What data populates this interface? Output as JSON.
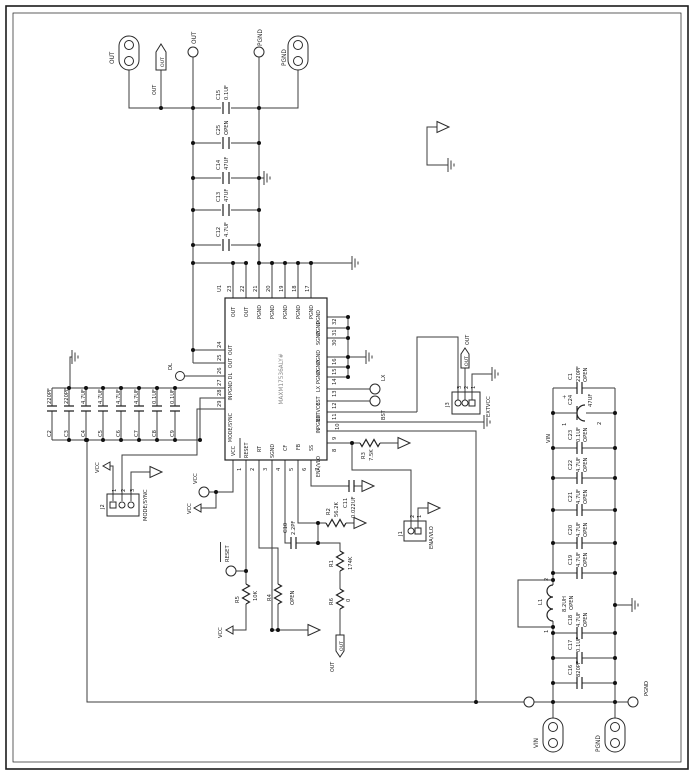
{
  "ic": {
    "ref": "U1",
    "part": "MAXM17536ALY#",
    "top_pins": [
      {
        "num": "23",
        "name": "OUT"
      },
      {
        "num": "22",
        "name": "OUT"
      },
      {
        "num": "21",
        "name": "PGND"
      },
      {
        "num": "20",
        "name": "PGND"
      },
      {
        "num": "19",
        "name": "PGND"
      },
      {
        "num": "18",
        "name": "PGND"
      },
      {
        "num": "17",
        "name": "PGND"
      }
    ],
    "left_pins": [
      {
        "num": "24",
        "name": "OUT"
      },
      {
        "num": "25",
        "name": "OUT"
      },
      {
        "num": "26",
        "name": "DL"
      },
      {
        "num": "27",
        "name": "PGND"
      },
      {
        "num": "28",
        "name": "IN"
      },
      {
        "num": "29",
        "name": "MODE/SYNC"
      }
    ],
    "right_pins": [
      {
        "num": "32",
        "name": "PGND"
      },
      {
        "num": "31",
        "name": "PGND"
      },
      {
        "num": "30",
        "name": "SGND"
      },
      {
        "num": "16",
        "name": "PGND"
      },
      {
        "num": "15",
        "name": "PGND"
      },
      {
        "num": "14",
        "name": "PGND"
      },
      {
        "num": "13",
        "name": "LX"
      },
      {
        "num": "12",
        "name": "BST"
      },
      {
        "num": "11",
        "name": "EXTVCC"
      },
      {
        "num": "10",
        "name": "PGND"
      },
      {
        "num": "9",
        "name": "IN"
      },
      {
        "num": "8",
        "name": "ENA/VLO"
      }
    ],
    "bottom_pins": [
      {
        "num": "1",
        "name": "VCC"
      },
      {
        "num": "2",
        "name": "RESET"
      },
      {
        "num": "3",
        "name": "RT"
      },
      {
        "num": "4",
        "name": "SGND"
      },
      {
        "num": "5",
        "name": "CF"
      },
      {
        "num": "6",
        "name": "FB"
      },
      {
        "num": "7",
        "name": "SS"
      }
    ]
  },
  "capacitors": {
    "C1": {
      "ref": "C1",
      "val": "220PF",
      "val2": "OPEN"
    },
    "C2": {
      "ref": "C2",
      "val": "220PF"
    },
    "C3": {
      "ref": "C3",
      "val": "220PF"
    },
    "C4": {
      "ref": "C4",
      "val": "4.7UF"
    },
    "C5": {
      "ref": "C5",
      "val": "4.7UF"
    },
    "C6": {
      "ref": "C6",
      "val": "4.7UF"
    },
    "C7": {
      "ref": "C7",
      "val": "4.7UF"
    },
    "C8": {
      "ref": "C8",
      "val": "0.1UF"
    },
    "C9": {
      "ref": "C9",
      "val": "0.1UF"
    },
    "C10": {
      "ref": "C10",
      "val": "2.2PF"
    },
    "C11": {
      "ref": "C11",
      "val": "0.022UF"
    },
    "C12": {
      "ref": "C12",
      "val": "4.7UF"
    },
    "C13": {
      "ref": "C13",
      "val": "47UF"
    },
    "C14": {
      "ref": "C14",
      "val": "47UF"
    },
    "C15": {
      "ref": "C15",
      "val": "0.1UF"
    },
    "C16": {
      "ref": "C16",
      "val": "820PF"
    },
    "C17": {
      "ref": "C17",
      "val": "0.1UF"
    },
    "C18": {
      "ref": "C18",
      "val": "4.7UF",
      "val2": "OPEN"
    },
    "C19": {
      "ref": "C19",
      "val": "4.7UF",
      "val2": "OPEN"
    },
    "C20": {
      "ref": "C20",
      "val": "4.7UF",
      "val2": "OPEN"
    },
    "C21": {
      "ref": "C21",
      "val": "4.7UF",
      "val2": "OPEN"
    },
    "C22": {
      "ref": "C22",
      "val": "4.7UF",
      "val2": "OPEN"
    },
    "C23": {
      "ref": "C23",
      "val": "0.1UF",
      "val2": "OPEN"
    },
    "C24": {
      "ref": "C24",
      "val": "47UF",
      "p1": "1",
      "p2": "2",
      "plus": "+"
    },
    "C25": {
      "ref": "C25",
      "val": "OPEN"
    }
  },
  "resistors": {
    "R1": {
      "ref": "R1",
      "val": "174K"
    },
    "R2": {
      "ref": "R2",
      "val": "56.2K"
    },
    "R3": {
      "ref": "R3",
      "val": "7.5K"
    },
    "R4": {
      "ref": "R4",
      "val": "OPEN"
    },
    "R5": {
      "ref": "R5",
      "val": "10K"
    },
    "R6": {
      "ref": "R6",
      "val": "0"
    }
  },
  "inductor": {
    "L1": {
      "ref": "L1",
      "val": "8.2UH",
      "val2": "OPEN",
      "p1": "1",
      "p2": "2"
    }
  },
  "headers": {
    "J1": {
      "ref": "J1",
      "label": "ENA/VLO",
      "p1": "1",
      "p2": "2"
    },
    "J2": {
      "ref": "J2",
      "label": "MODE/SYNC",
      "p1": "1",
      "p2": "2",
      "p3": "3"
    },
    "J3": {
      "ref": "J3",
      "label": "EXTVCC",
      "p1": "1",
      "p2": "2",
      "p3": "3"
    }
  },
  "testpoints": {
    "out": "OUT",
    "pgnd": "PGND",
    "dl": "DL",
    "vcc": "VCC",
    "reset": "RESET",
    "lx": "LX",
    "bst": "BST",
    "pgnd_filter": "PGND"
  },
  "pads": {
    "out": "OUT",
    "pgnd": "PGND",
    "vin": "VIN",
    "pgnd2": "PGND"
  },
  "net_labels": {
    "out_flag_top": "OUT",
    "out_flag_top_label": "OUT",
    "out_flag_j3": "OUT",
    "out_flag_j3_label": "OUT",
    "out_flag_fb": "OUT",
    "out_flag_fb_label": "OUT",
    "vcc_j2": "VCC",
    "vcc_tp_arrow": "VCC",
    "vcc_r5": "VCC",
    "vin_rail": "VIN"
  }
}
